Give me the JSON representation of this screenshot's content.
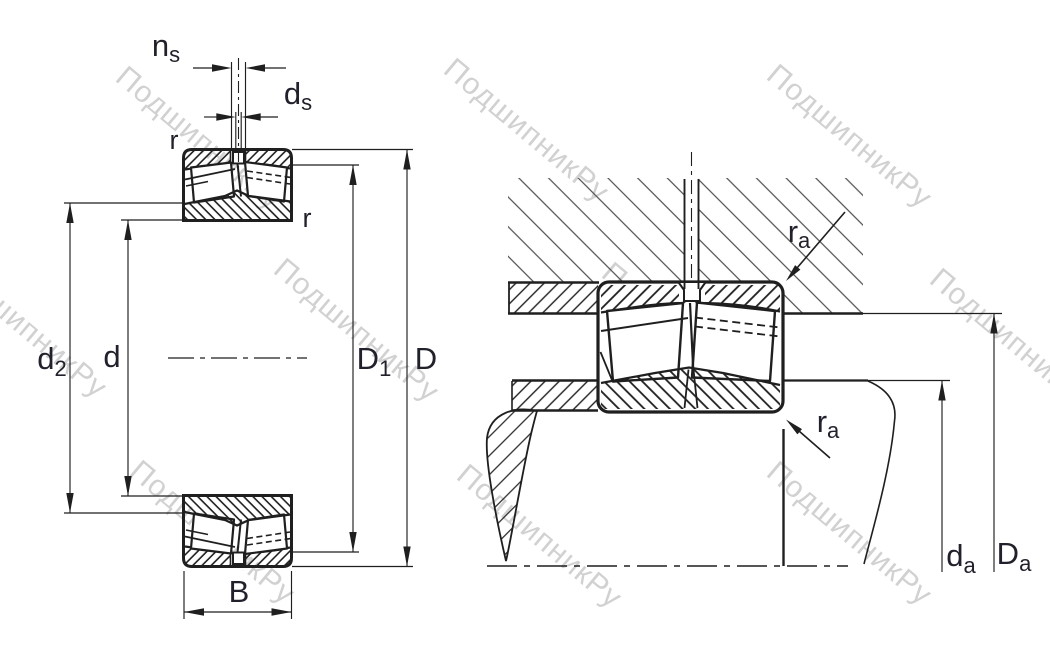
{
  "title": "Spherical roller bearing — boundary and abutment dimensions drawing",
  "watermark": {
    "text": "ПодшипникРу",
    "color": "#c9c9c9"
  },
  "colors": {
    "line": "#1f1f1f",
    "label": "#21212c",
    "housing_hatch": "#4d4d4d",
    "background": "#ffffff"
  },
  "left_view": {
    "ns": {
      "main": "n",
      "sub": "s"
    },
    "ds": {
      "main": "d",
      "sub": "s"
    },
    "r_top": "r",
    "r_side": "r",
    "d2": {
      "main": "d",
      "sub": "2"
    },
    "d": "d",
    "D1": {
      "main": "D",
      "sub": "1"
    },
    "D": "D",
    "B": "B"
  },
  "right_view": {
    "ra_top": {
      "main": "r",
      "sub": "a"
    },
    "ra_bottom": {
      "main": "r",
      "sub": "a"
    },
    "da": {
      "main": "d",
      "sub": "a"
    },
    "Da": {
      "main": "D",
      "sub": "a"
    }
  }
}
